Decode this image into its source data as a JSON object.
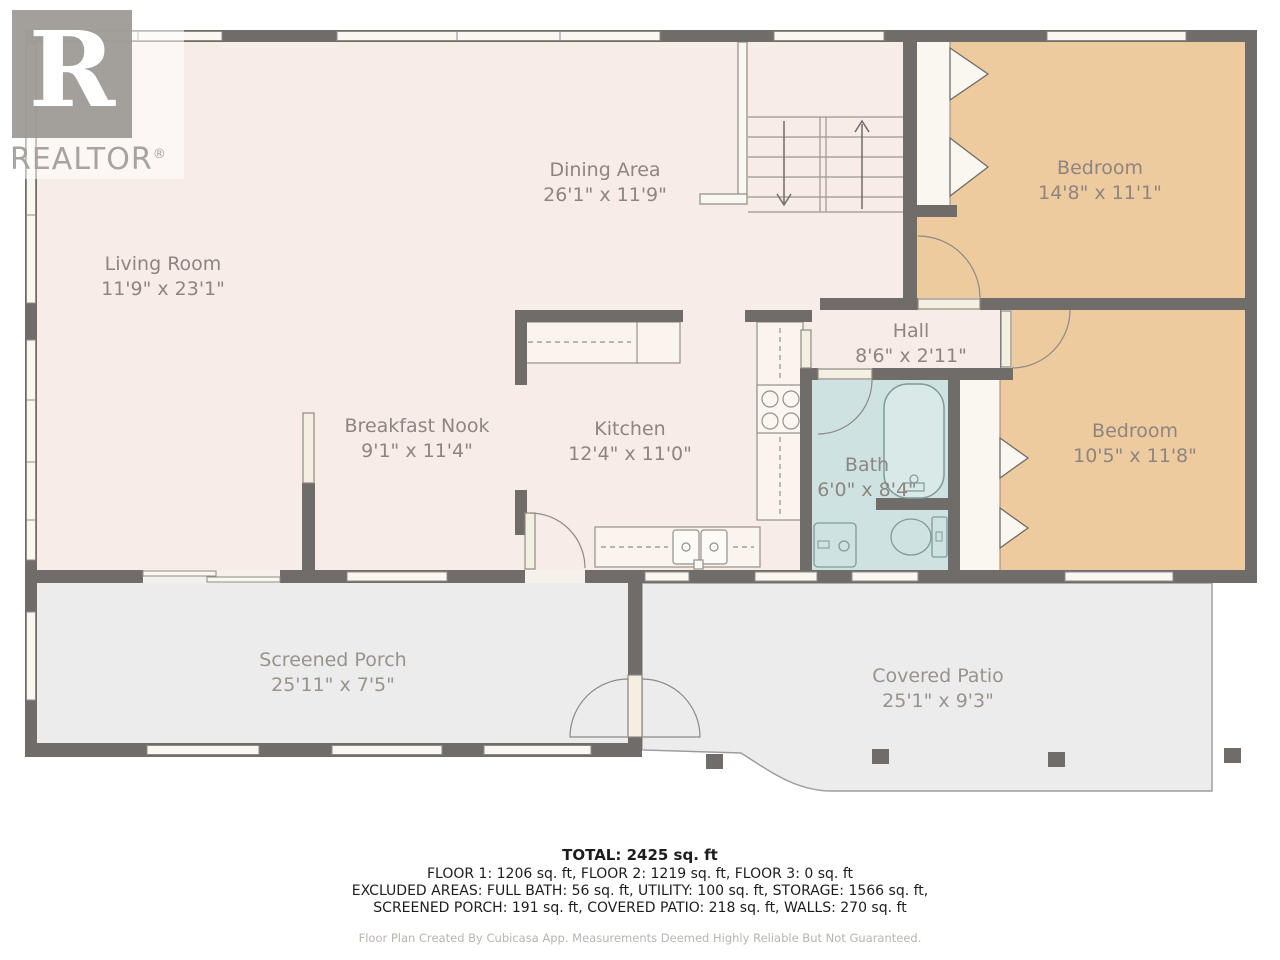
{
  "logo": {
    "letter": "R",
    "wordmark": "REALTOR",
    "registered": "®"
  },
  "rooms": [
    {
      "id": "living-room",
      "name": "Living Room",
      "dims": "11'9\" x 23'1\""
    },
    {
      "id": "dining-area",
      "name": "Dining Area",
      "dims": "26'1\" x 11'9\""
    },
    {
      "id": "bedroom-1",
      "name": "Bedroom",
      "dims": "14'8\" x 11'1\""
    },
    {
      "id": "hall",
      "name": "Hall",
      "dims": "8'6\" x 2'11\""
    },
    {
      "id": "breakfast-nook",
      "name": "Breakfast Nook",
      "dims": "9'1\" x 11'4\""
    },
    {
      "id": "kitchen",
      "name": "Kitchen",
      "dims": "12'4\" x 11'0\""
    },
    {
      "id": "bath",
      "name": "Bath",
      "dims": "6'0\" x 8'4\""
    },
    {
      "id": "bedroom-2",
      "name": "Bedroom",
      "dims": "10'5\" x 11'8\""
    },
    {
      "id": "screened-porch",
      "name": "Screened Porch",
      "dims": "25'11\" x 7'5\""
    },
    {
      "id": "covered-patio",
      "name": "Covered Patio",
      "dims": "25'1\" x 9'3\""
    }
  ],
  "summary": {
    "total": "TOTAL: 2425 sq. ft",
    "floors": "FLOOR 1: 1206 sq. ft, FLOOR 2: 1219 sq. ft, FLOOR 3: 0 sq. ft",
    "excluded_line1": "EXCLUDED AREAS: FULL BATH: 56 sq. ft, UTILITY: 100 sq. ft, STORAGE: 1566 sq. ft,",
    "excluded_line2": "SCREENED PORCH: 191 sq. ft, COVERED PATIO: 218 sq. ft, WALLS: 270 sq. ft",
    "disclaimer": "Floor Plan Created By Cubicasa App. Measurements Deemed Highly Reliable But Not Guaranteed."
  },
  "colors": {
    "wall": "#6f6c69",
    "floor_main": "#f8ece6",
    "floor_bedroom": "#eeca9f",
    "floor_bath": "#cee3e1",
    "floor_outdoor": "#ececec",
    "window_fill": "#faf7f0",
    "fixture_stroke": "#7f9a98",
    "label_text": "#8d8680"
  }
}
